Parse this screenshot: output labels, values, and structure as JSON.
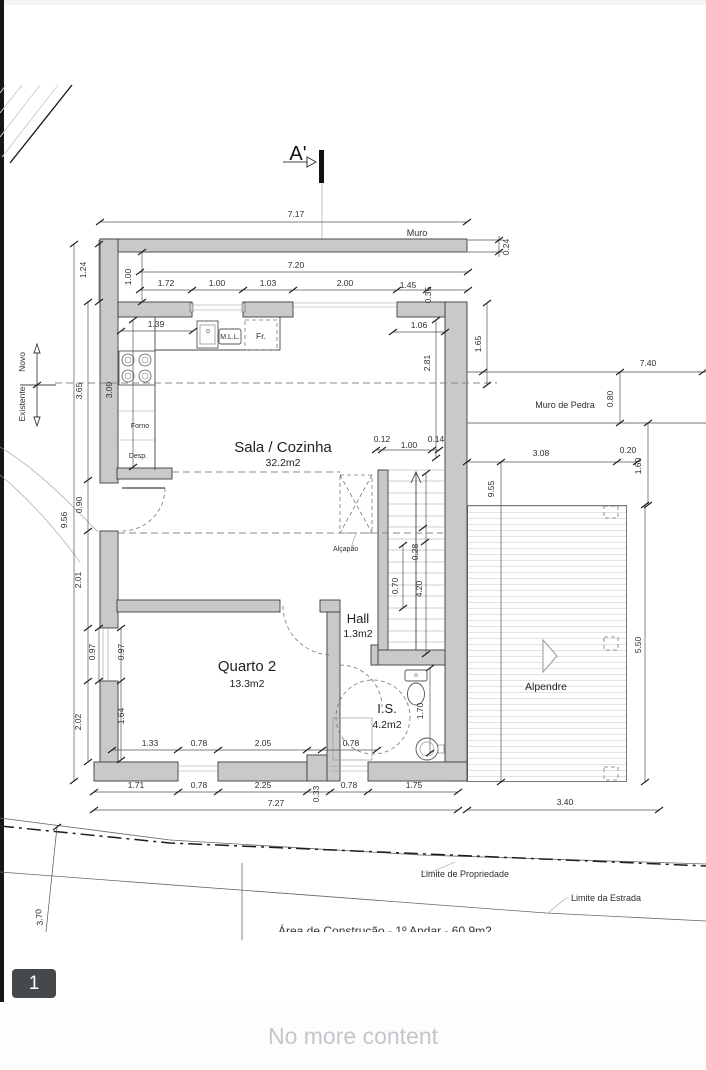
{
  "viewer": {
    "page_badge": "1",
    "end_message": "No more content"
  },
  "plan": {
    "section_marker": "A'",
    "labels": {
      "muro": "Muro",
      "muro_de_pedra": "Muro de Pedra",
      "novo": "Novo",
      "existente": "Existente",
      "forno": "Forno",
      "desp": "Desp.",
      "mll": "M.L.L.",
      "fr": "Fr.",
      "alcapao": "Alçapão",
      "limite_propriedade": "Limite de Propriedade",
      "limite_estrada": "Limite da Estrada",
      "area_note": "Área de Construção - 1º Andar - 60.9m2"
    },
    "rooms": {
      "sala": {
        "name": "Sala / Cozinha",
        "area": "32.2m2"
      },
      "quarto2": {
        "name": "Quarto 2",
        "area": "13.3m2"
      },
      "hall": {
        "name": "Hall",
        "area": "1.3m2"
      },
      "is": {
        "name": "I.S.",
        "area": "4.2m2"
      },
      "alpendre": {
        "name": "Alpendre"
      }
    },
    "dims": {
      "muro_total": "7.17",
      "muro_thickness": "0.24",
      "top_width": "7.20",
      "top_row": [
        "1.72",
        "1.00",
        "1.03",
        "2.00",
        "1.45"
      ],
      "top_jog": "0.35",
      "left_inset_a": "1.24",
      "left_inset_b": "1.00",
      "left_col": [
        "3.65",
        "0.90",
        "2.01",
        "0.97",
        "2.02"
      ],
      "left_total": "9.56",
      "kitchen_counter": "1.39",
      "kitchen_depth": "3.09",
      "win_right": "1.06",
      "right_inner": "2.81",
      "right_outer": "1.65",
      "stone_len": "7.40",
      "stone_w": "0.80",
      "stair_row": [
        "0.12",
        "1.00",
        "0.14"
      ],
      "stair_tread": "0.28",
      "stair_width": "0.70",
      "stair_len": "4.20",
      "porch_top": "3.08",
      "porch_post": "0.20",
      "porch_r": "1.60",
      "porch_h": "5.50",
      "porch_left": "9.55",
      "porch_bottom": "3.40",
      "quarto_win": "0.97",
      "quarto_low": "1.64",
      "is_h": "1.70",
      "inner_row": [
        "1.33",
        "0.78",
        "2.05",
        "0.78"
      ],
      "bottom_row": [
        "1.71",
        "0.78",
        "2.25",
        "0.78",
        "1.75"
      ],
      "bottom_jog": "0.33",
      "bottom_total": "7.27",
      "site_d": "3.70"
    }
  }
}
